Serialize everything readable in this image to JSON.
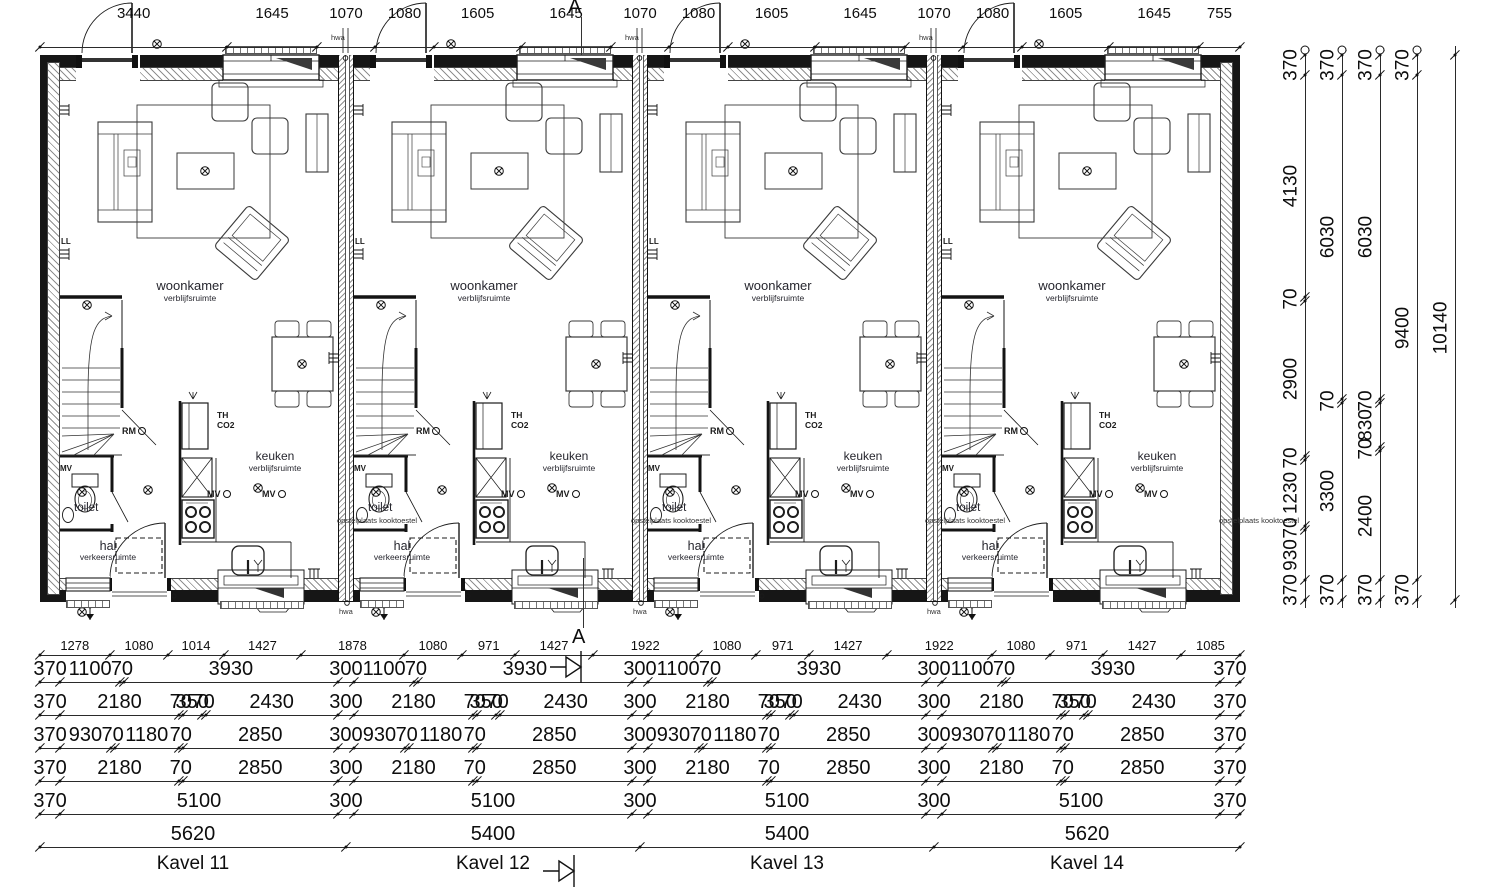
{
  "section": {
    "label": "A"
  },
  "unit_labels": {
    "woonkamer": "woonkamer",
    "verblijfsruimte": "verblijfsruimte",
    "keuken": "keuken",
    "toilet": "toilet",
    "hal": "hal",
    "verkeersruimte": "verkeersruimte",
    "rm": "RM",
    "mv": "MV",
    "th": "TH",
    "co2": "CO2",
    "ll": "LL",
    "hwa": "hwa",
    "opstelplaats": "opstelplaats kooktoestel"
  },
  "units": [
    {
      "name": "Kavel 11",
      "hwa_top": true,
      "hwa_bottom": true
    },
    {
      "name": "Kavel 12",
      "hwa_top": true,
      "hwa_bottom": true
    },
    {
      "name": "Kavel 13",
      "hwa_top": true,
      "hwa_bottom": true
    },
    {
      "name": "Kavel 14",
      "hwa_top": false,
      "hwa_bottom": false
    }
  ],
  "plots": [
    {
      "label": "Kavel 11"
    },
    {
      "label": "Kavel 12"
    },
    {
      "label": "Kavel 13"
    },
    {
      "label": "Kavel 14"
    }
  ],
  "dimensions": {
    "top": [
      3440,
      1645,
      1070,
      1080,
      1605,
      1645,
      1070,
      1080,
      1605,
      1645,
      1070,
      1080,
      1605,
      1645,
      755
    ],
    "bottom_rows": [
      [
        1278,
        1080,
        1014,
        1427,
        1878,
        1080,
        971,
        1427,
        1922,
        1080,
        971,
        1427,
        1922,
        1080,
        971,
        1427,
        1085
      ],
      [
        370,
        1100,
        70,
        3930,
        300,
        1100,
        70,
        3930,
        300,
        1100,
        70,
        3930,
        300,
        1100,
        70,
        3930,
        370
      ],
      [
        370,
        2180,
        70,
        350,
        70,
        2430,
        300,
        2180,
        70,
        350,
        70,
        2430,
        300,
        2180,
        70,
        350,
        70,
        2430,
        300,
        2180,
        70,
        350,
        70,
        2430,
        370
      ],
      [
        370,
        930,
        70,
        1180,
        70,
        2850,
        300,
        930,
        70,
        1180,
        70,
        2850,
        300,
        930,
        70,
        1180,
        70,
        2850,
        300,
        930,
        70,
        1180,
        70,
        2850,
        370
      ],
      [
        370,
        2180,
        70,
        2850,
        300,
        2180,
        70,
        2850,
        300,
        2180,
        70,
        2850,
        300,
        2180,
        70,
        2850,
        370
      ],
      [
        370,
        5100,
        300,
        5100,
        300,
        5100,
        300,
        5100,
        370
      ],
      [
        5620,
        5400,
        5400,
        5620
      ]
    ],
    "right_columns": [
      [
        370,
        4130,
        70,
        2900,
        70,
        1230,
        70,
        930,
        370
      ],
      [
        370,
        6030,
        70,
        3300,
        370
      ],
      [
        370,
        6030,
        70,
        830,
        70,
        2400,
        370
      ],
      [
        370,
        9400,
        370
      ],
      [
        10140
      ]
    ]
  }
}
